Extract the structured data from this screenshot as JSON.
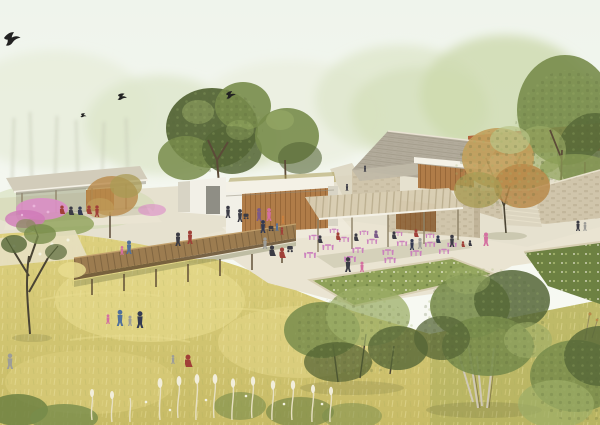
{
  "scene": {
    "type": "architectural landscape rendering",
    "description": "Aerial-perspective rendering of a park visitor campus: a thin-roofed shade pavilion and timber-slat building on the left, a stone hall with a pergola cafe terrace of pink bistro furniture at center-right, a long terracotta-roofed hall behind, a stone retaining wall with steps on the right, and a raised timber boardwalk crossing a golden wildflower meadow dotted with visitors, green trees and four birds in a hazy pale sky.",
    "inventory": {
      "birds": 4,
      "buildings": [
        "left shade pavilion",
        "timber-slat visitor building",
        "stone hall with cafe pergola",
        "terracotta-roofed hall"
      ],
      "features": [
        "raised timber boardwalk on posts",
        "golden wildflower meadow",
        "cafe terrace with pink bistro tables and chairs",
        "planted beds with stone curbs",
        "stone retaining wall with steps",
        "paved paths"
      ],
      "people_groups": [
        "seated group under left pavilion",
        "walkers on boardwalk",
        "cafe guests",
        "families in the meadow",
        "visitors at building entrance",
        "strollers on right path"
      ]
    }
  },
  "palette": {
    "sky-top": "#eff4ec",
    "sky-bottom": "#fafbf4",
    "haze-pale": "#e9eedd",
    "haze-mid": "#dde6ca",
    "haze-green": "#cdd9ae",
    "haze-deep": "#bfd09b",
    "trunk-haze": "#c6cab6",
    "ground-base": "#e4decb",
    "meadow-top": "#ddd07e",
    "meadow-bottom": "#c7bb66",
    "meadow-light": "#e8dc8e",
    "meadow-olive": "#a9ad5e",
    "grass-flec": "#efe6a8",
    "plume": "#f2eedb",
    "plume-stroke": "#e7e0c2",
    "flower-white": "#f3f2e1",
    "path": "#eae4d2",
    "path-shade": "#dcd5c0",
    "path-bright": "#efeadb",
    "bed-green": "#8fa159",
    "bed-dark": "#6d8142",
    "bed-light": "#aebd72",
    "curb": "#d8cfb3",
    "boardwalk": "#9c7c50",
    "boardwalk-dark": "#6b5435",
    "boardwalk-lite": "#c2a06c",
    "post": "#5c4a33",
    "canopy": "#d2ccba",
    "canopy-shadow": "#8f897a",
    "fascia": "#f4f1e6",
    "slat": "#b07c48",
    "slat-dark": "#885a2e",
    "white-wall": "#f2f0e7",
    "wall-shade": "#d8d4c5",
    "opening": "#6e6e64",
    "roof-gray": "#b2ab9b",
    "roof-line": "#938b79",
    "ridge": "#e9e3d3",
    "porch-roof": "#c0b9a7",
    "stone": "#d0c5ab",
    "stone-dark": "#b1a488",
    "stone-edge": "#e9e2cd",
    "terracotta": "#b05a34",
    "terracotta-dark": "#7e3f24",
    "terracotta-wall": "#e9e1cd",
    "pergola": "#d8cdb2",
    "pergola-beam": "#b6a989",
    "pergola-post": "#8d8166",
    "tree-dark": "#556637",
    "tree-mid": "#788c4b",
    "tree-light": "#9cae67",
    "tree-pale": "#b9c488",
    "autumn1": "#c2a05c",
    "autumn2": "#b98a4a",
    "autumn-green": "#a99b54",
    "trunk": "#5b4b38",
    "trunk-pale": "#cfc8b6",
    "branch": "#4a4434",
    "bush-dark": "#4f5e31",
    "shadow": "#5d6338",
    "twig": "#8a7d5a",
    "pink-flower": "#dc8fc7",
    "pink-deep": "#cf79b8",
    "pink-pale": "#eab4da",
    "cafe-pink": "#ca7cbd",
    "fig-dark": "#3b3b44",
    "fig-red": "#a04038",
    "fig-blue": "#51709a",
    "fig-pink": "#d470a0",
    "fig-gray": "#9d9d98",
    "fig-purple": "#7b5a88",
    "fig-orange": "#c9803e",
    "fig-navy": "#333a52",
    "bird": "#222222"
  }
}
